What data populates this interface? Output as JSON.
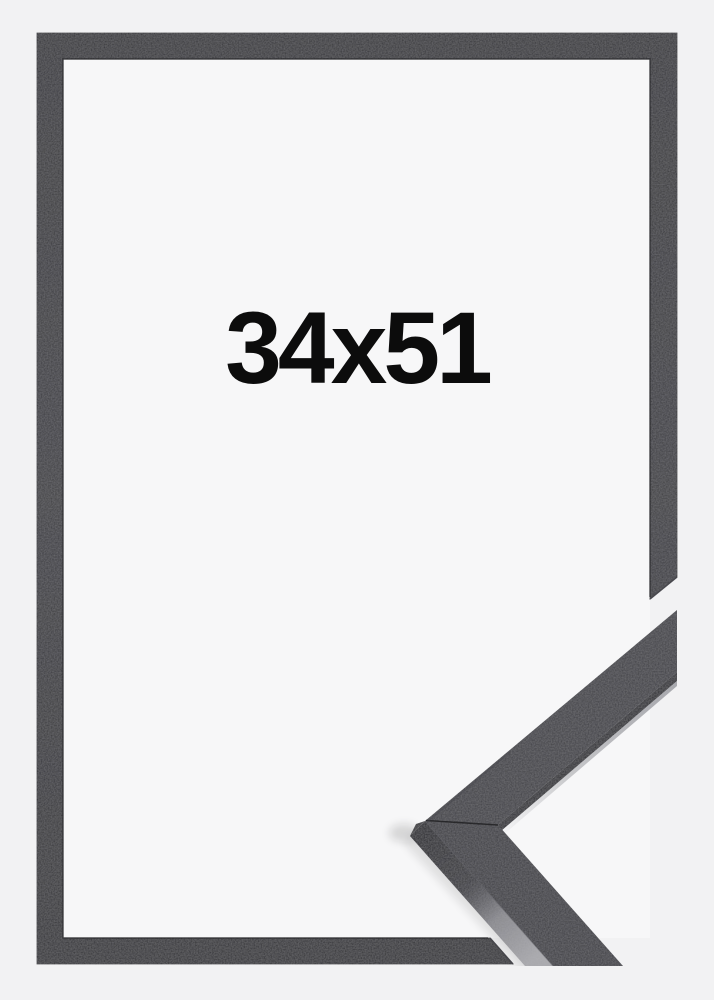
{
  "product": {
    "size_label": "34x51",
    "frame_style": "black"
  },
  "icons": {
    "frame_corner_sample": "mitred-corner-chevron"
  },
  "colors": {
    "background": "#f2f2f3",
    "paper": "#f7f7f8",
    "frame_front": "#38383c",
    "frame_edge_dark": "#26262a",
    "moulding_side_dark": "#242428",
    "moulding_side_highlight": "#a7a7ab",
    "label_text": "#0c0c0c"
  }
}
